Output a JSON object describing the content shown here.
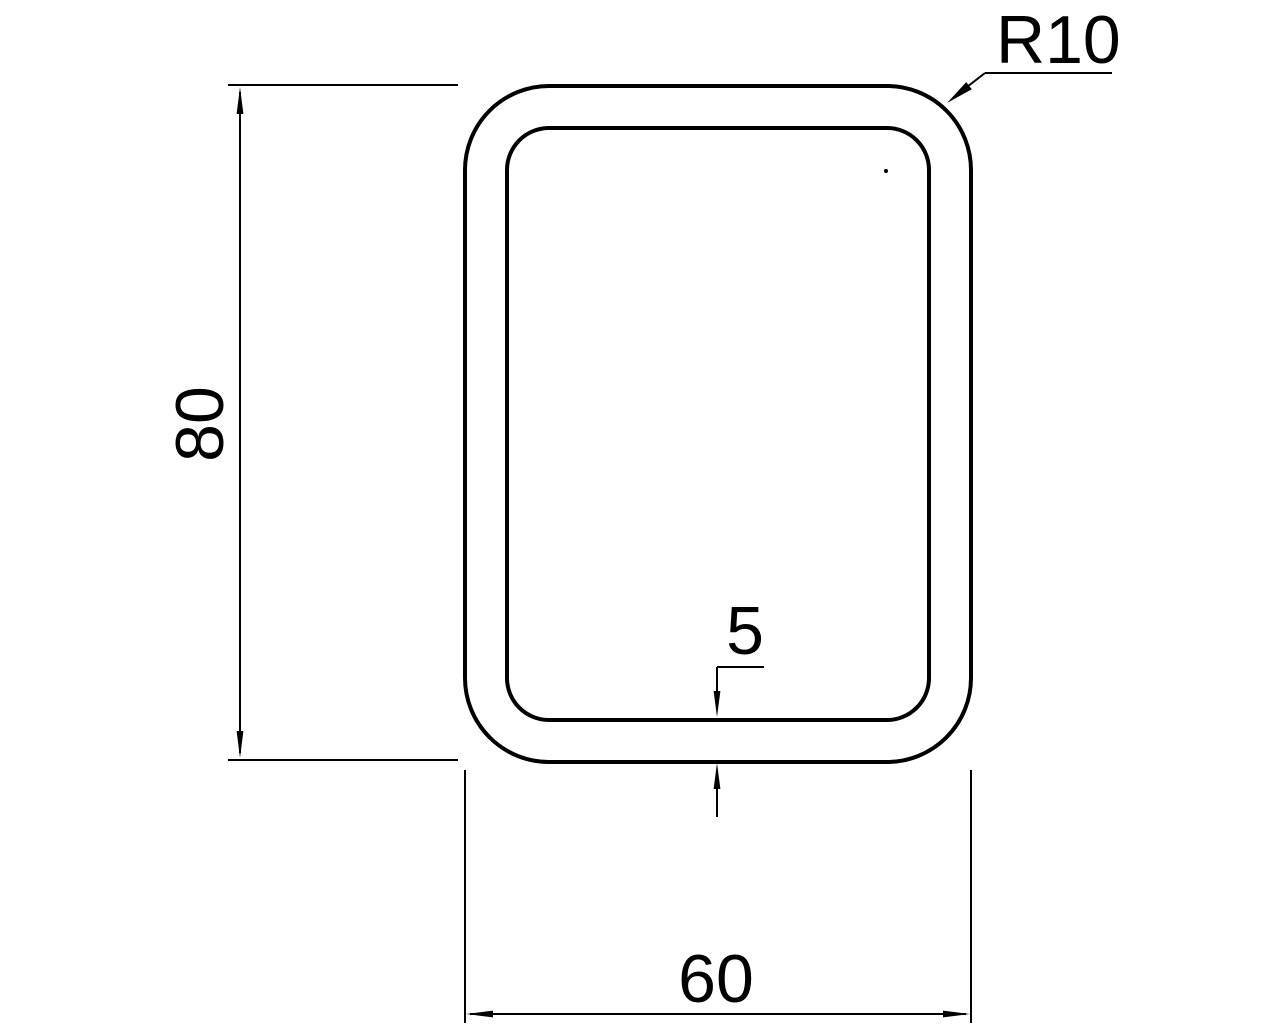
{
  "diagram": {
    "type": "technical-drawing-cross-section",
    "labels": {
      "height": "80",
      "width": "60",
      "wall_thickness": "5",
      "corner_radius": "R10"
    },
    "colors": {
      "line": "#000000",
      "background": "#ffffff"
    }
  }
}
